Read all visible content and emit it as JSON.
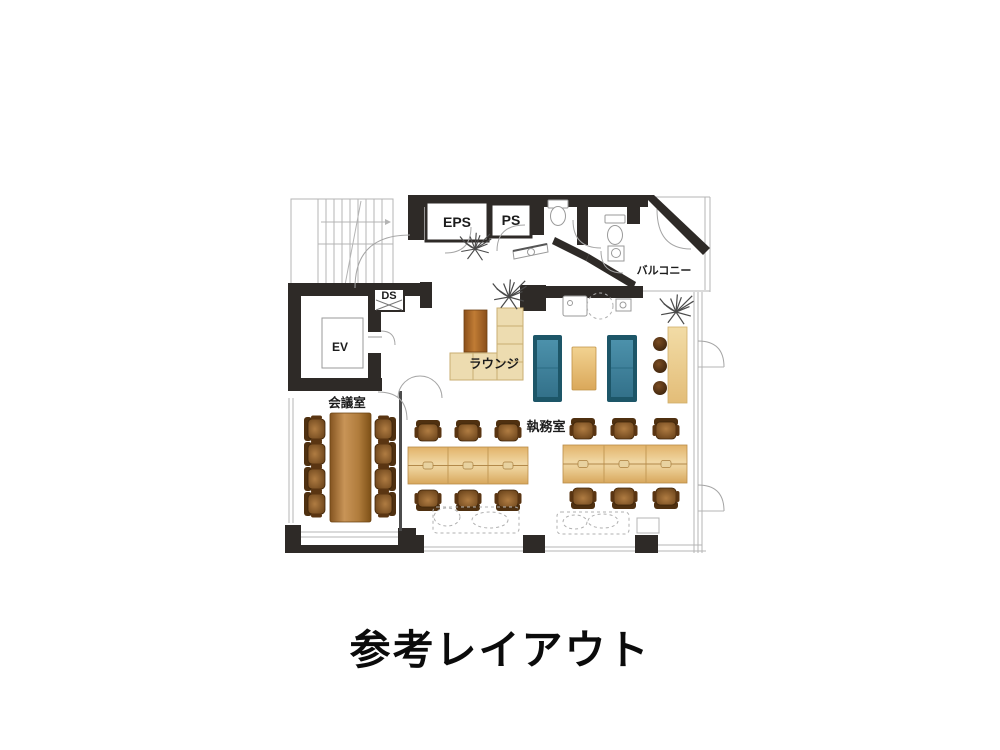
{
  "caption": "参考レイアウト",
  "plan": {
    "labels": {
      "eps": "EPS",
      "ps": "PS",
      "ds": "DS",
      "ev": "EV",
      "balcony": "バルコニー",
      "lounge": "ラウンジ",
      "meeting_room": "会議室",
      "office": "執務室"
    },
    "furniture_counts": {
      "meeting_room_chairs": 8,
      "meeting_tables": 1,
      "office_desk_islands": 2,
      "office_chairs_per_island": 6,
      "teal_sofas": 2,
      "lounge_l_sofa": 1,
      "lounge_tables": 2,
      "counter_stools": 3,
      "plants": 3,
      "toilets": 2
    },
    "colors": {
      "wall": "#2e2a27",
      "wood_dark": "#8a5a22",
      "wood_light": "#e9c57f",
      "sofa_teal": "#1d5668",
      "sofa_beige": "#eddcb0",
      "chair_brown": "#6b4218",
      "line_light": "#b4b4b4"
    }
  }
}
